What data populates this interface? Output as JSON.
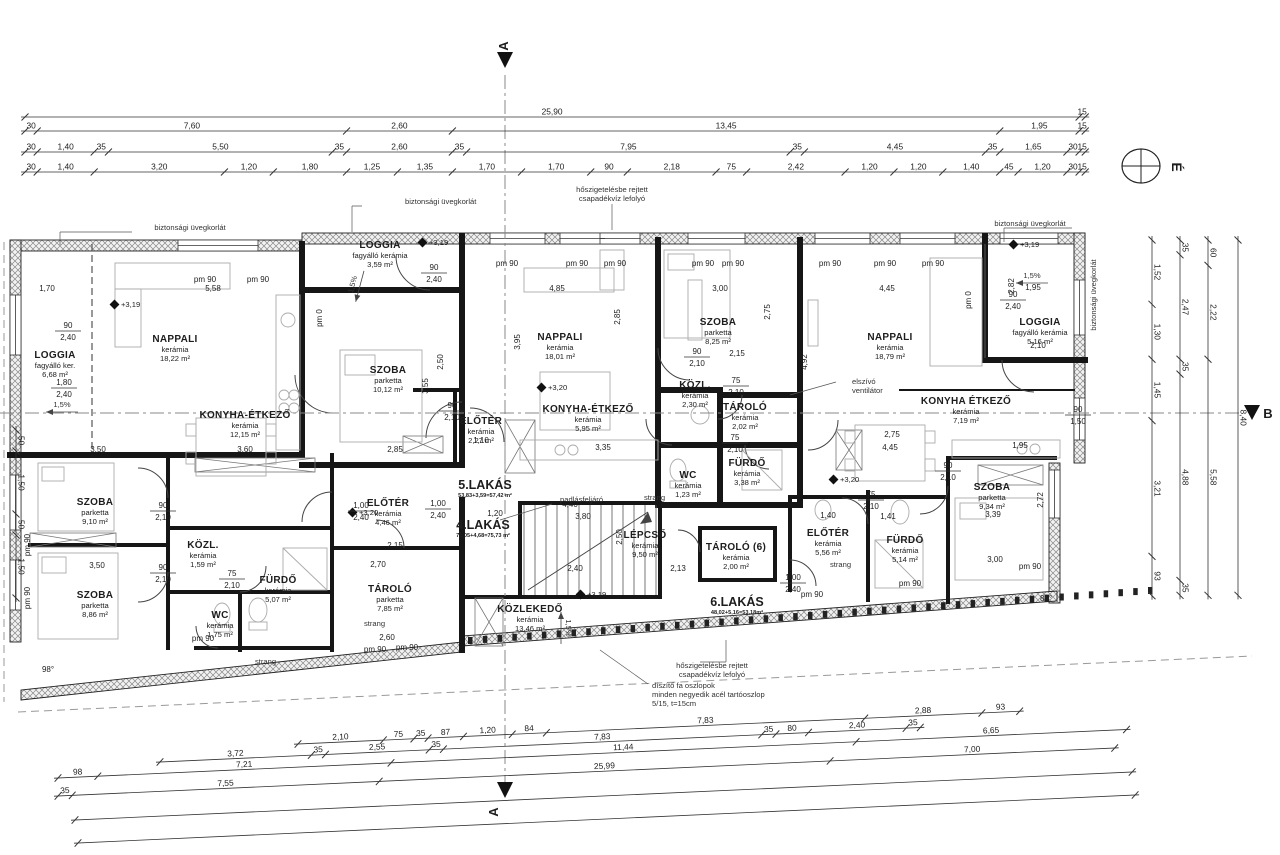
{
  "drawing": {
    "north_label": "É",
    "section_top": "A",
    "section_bottom": "A",
    "section_right": "B",
    "section_right_dim": "8,40",
    "window_sill_label": "pm 90",
    "window_zero_label": "pm 0"
  },
  "rooms": [
    {
      "id": "loggia1",
      "name": "LOGGIA",
      "material": "fagyálló ker.",
      "area": "6,68 m²"
    },
    {
      "id": "nappali1",
      "name": "NAPPALI",
      "material": "kerámia",
      "area": "18,22 m²"
    },
    {
      "id": "konyha1",
      "name": "KONYHA-ÉTKEZŐ",
      "material": "kerámia",
      "area": "12,15 m²"
    },
    {
      "id": "loggia2",
      "name": "LOGGIA",
      "material": "fagyálló kerámia",
      "area": "3,59 m²"
    },
    {
      "id": "szoba1",
      "name": "SZOBA",
      "material": "parketta",
      "area": "10,12 m²"
    },
    {
      "id": "eloter3",
      "name": "ELŐTÉR",
      "material": "kerámia",
      "area": "2,27 m²"
    },
    {
      "id": "nappali2",
      "name": "NAPPALI",
      "material": "kerámia",
      "area": "18,01 m²"
    },
    {
      "id": "konyha2",
      "name": "KONYHA-ÉTKEZŐ",
      "material": "kerámia",
      "area": "5,95 m²"
    },
    {
      "id": "szoba4",
      "name": "SZOBA",
      "material": "parketta",
      "area": "8,25 m²"
    },
    {
      "id": "kozl2",
      "name": "KÖZL.",
      "material": "kerámia",
      "area": "2,30 m²"
    },
    {
      "id": "tarolo2",
      "name": "TÁROLÓ",
      "material": "kerámia",
      "area": "2,02 m²"
    },
    {
      "id": "furdo2",
      "name": "FÜRDŐ",
      "material": "kerámia",
      "area": "3,38 m²"
    },
    {
      "id": "wc2",
      "name": "WC",
      "material": "kerámia",
      "area": "1,23 m²"
    },
    {
      "id": "nappali3",
      "name": "NAPPALI",
      "material": "kerámia",
      "area": "18,79 m²"
    },
    {
      "id": "konyha3",
      "name": "KONYHA ÉTKEZŐ",
      "material": "kerámia",
      "area": "7,19 m²"
    },
    {
      "id": "loggia3",
      "name": "LOGGIA",
      "material": "fagyálló kerámia",
      "area": "5,16 m²"
    },
    {
      "id": "szoba2",
      "name": "SZOBA",
      "material": "parketta",
      "area": "9,10 m²"
    },
    {
      "id": "szoba3",
      "name": "SZOBA",
      "material": "parketta",
      "area": "8,86 m²"
    },
    {
      "id": "kozl1",
      "name": "KÖZL.",
      "material": "kerámia",
      "area": "1,59 m²"
    },
    {
      "id": "furdo1",
      "name": "FÜRDŐ",
      "material": "kerámia",
      "area": "5,07 m²"
    },
    {
      "id": "wc1",
      "name": "WC",
      "material": "kerámia",
      "area": "1,75 m²"
    },
    {
      "id": "eloter1",
      "name": "ELŐTÉR",
      "material": "kerámia",
      "area": "4,46 m²"
    },
    {
      "id": "tarolo1",
      "name": "TÁROLÓ",
      "material": "parketta",
      "area": "7,85 m²"
    },
    {
      "id": "lepcso",
      "name": "LÉPCSŐ",
      "material": "kerámia",
      "area": "9,50 m²"
    },
    {
      "id": "kozlekedo",
      "name": "KÖZLEKEDŐ",
      "material": "kerámia",
      "area": "13,46 m²"
    },
    {
      "id": "tarolo6",
      "name": "TÁROLÓ (6)",
      "material": "kerámia",
      "area": "2,00 m²"
    },
    {
      "id": "eloter6",
      "name": "ELŐTÉR",
      "material": "kerámia",
      "area": "5,56 m²"
    },
    {
      "id": "furdo6",
      "name": "FÜRDŐ",
      "material": "kerámia",
      "area": "5,14 m²"
    },
    {
      "id": "szoba6",
      "name": "SZOBA",
      "material": "parketta",
      "area": "9,34 m²"
    }
  ],
  "apartments": [
    {
      "id": "a5",
      "name": "5.LAKÁS",
      "calc": "53,83+3,59=57,42 m²"
    },
    {
      "id": "a4",
      "name": "4.LAKÁS",
      "calc": "71,05+4,68=75,73 m²"
    },
    {
      "id": "a6",
      "name": "6.LAKÁS",
      "calc": "48,02+5,16=53,18m²"
    }
  ],
  "annotations": {
    "uvegkorlat": "biztonsági üvegkorlát",
    "csapadek1": "hőszigetelésbe rejtett",
    "csapadek2": "csapadékvíz lefolyó",
    "elszivo1": "elszívó",
    "elszivo2": "ventilátor",
    "padlas": "padlásfeljáró",
    "strang": "strang",
    "oszlop1": "díszítő fa oszlopok",
    "oszlop2": "minden negyedik acél tartóoszlop",
    "oszlop3": "5/15, t=15cm"
  },
  "levels": {
    "l319": "+3,19",
    "l320": "+3,20"
  },
  "slope": "1,5%",
  "angles": {
    "a98": "98°",
    "a82": "82°"
  },
  "door_labels": [
    {
      "id": "dl1",
      "top": "90",
      "bottom": "2,40"
    },
    {
      "id": "dl2",
      "top": "1,80",
      "bottom": "2,40"
    },
    {
      "id": "dl3",
      "top": "90",
      "bottom": "2,10"
    },
    {
      "id": "dl4",
      "top": "75",
      "bottom": "2,10"
    },
    {
      "id": "dl5",
      "top": "90",
      "bottom": "2,10"
    },
    {
      "id": "dl6",
      "top": "1,00",
      "bottom": "2,40"
    },
    {
      "id": "dl7",
      "top": "1,00",
      "bottom": "2,40"
    },
    {
      "id": "dl8",
      "top": "90",
      "bottom": "2,10"
    },
    {
      "id": "dl9",
      "top": "90",
      "bottom": "2,40"
    },
    {
      "id": "dl10",
      "top": "90",
      "bottom": "2,10"
    },
    {
      "id": "dl11",
      "top": "75",
      "bottom": "2,10"
    },
    {
      "id": "dl12",
      "top": "75",
      "bottom": "2,10"
    },
    {
      "id": "dl14",
      "top": "75",
      "bottom": "2,10"
    },
    {
      "id": "dl15",
      "top": "90",
      "bottom": "2,10"
    },
    {
      "id": "dl16",
      "top": "90",
      "bottom": "1,50"
    },
    {
      "id": "dl17",
      "top": "1,00",
      "bottom": "2,40"
    },
    {
      "id": "dl19",
      "top": "90",
      "bottom": "2,40"
    }
  ],
  "dims": [
    {
      "id": "d170",
      "text": "1,70"
    },
    {
      "id": "d558",
      "text": "5,58"
    },
    {
      "id": "d350a",
      "text": "3,50"
    },
    {
      "id": "d360",
      "text": "3,60"
    },
    {
      "id": "d285a",
      "text": "2,85"
    },
    {
      "id": "d485",
      "text": "4,85"
    },
    {
      "id": "d300a",
      "text": "3,00"
    },
    {
      "id": "d445a",
      "text": "4,45"
    },
    {
      "id": "d215a",
      "text": "2,15"
    },
    {
      "id": "d275a",
      "text": "2,75"
    },
    {
      "id": "d445b",
      "text": "4,45"
    },
    {
      "id": "d195a",
      "text": "1,95"
    },
    {
      "id": "d335",
      "text": "3,35"
    },
    {
      "id": "d195b",
      "text": "1,95"
    },
    {
      "id": "d282",
      "text": "2,82"
    },
    {
      "id": "d350b",
      "text": "3,50"
    },
    {
      "id": "d215b",
      "text": "2,15"
    },
    {
      "id": "d270",
      "text": "2,70"
    },
    {
      "id": "d260",
      "text": "2,60"
    },
    {
      "id": "d141",
      "text": "1,41"
    },
    {
      "id": "d339",
      "text": "3,39"
    },
    {
      "id": "d300b",
      "text": "3,00"
    },
    {
      "id": "d440",
      "text": "4,40"
    },
    {
      "id": "d380",
      "text": "3,80"
    },
    {
      "id": "d240s",
      "text": "2,40"
    },
    {
      "id": "d213",
      "text": "2,13"
    },
    {
      "id": "d140",
      "text": "1,40"
    },
    {
      "id": "d120",
      "text": "1,20"
    },
    {
      "id": "d395r",
      "text": "3,95"
    },
    {
      "id": "d285r",
      "text": "2,85"
    },
    {
      "id": "d250r",
      "text": "2,50"
    },
    {
      "id": "d355r",
      "text": "3,55"
    },
    {
      "id": "d275r",
      "text": "2,75"
    },
    {
      "id": "d492r",
      "text": "4,92"
    },
    {
      "id": "d250s",
      "text": "2,50"
    },
    {
      "id": "d272r",
      "text": "2,72"
    },
    {
      "id": "d110",
      "text": "1,10"
    },
    {
      "id": "d210r",
      "text": "2,10"
    }
  ],
  "dim_chains": {
    "top": [
      {
        "id": "t1",
        "segments": [
          {
            "v": 25.9,
            "label": "25,90"
          },
          {
            "v": 0.15,
            "label": "15"
          }
        ]
      },
      {
        "id": "t2",
        "segments": [
          {
            "v": 0.3,
            "label": "30"
          },
          {
            "v": 7.6,
            "label": "7,60"
          },
          {
            "v": 2.6,
            "label": "2,60"
          },
          {
            "v": 13.45,
            "label": "13,45"
          },
          {
            "v": 1.95,
            "label": "1,95"
          },
          {
            "v": 0.15,
            "label": "15"
          }
        ]
      },
      {
        "id": "t3",
        "segments": [
          {
            "v": 0.3,
            "label": "30"
          },
          {
            "v": 1.4,
            "label": "1,40"
          },
          {
            "v": 0.35,
            "label": "35"
          },
          {
            "v": 5.5,
            "label": "5,50"
          },
          {
            "v": 0.35,
            "label": "35"
          },
          {
            "v": 2.6,
            "label": "2,60"
          },
          {
            "v": 0.35,
            "label": "35"
          },
          {
            "v": 7.95,
            "label": "7,95"
          },
          {
            "v": 0.35,
            "label": "35"
          },
          {
            "v": 4.45,
            "label": "4,45"
          },
          {
            "v": 0.35,
            "label": "35"
          },
          {
            "v": 1.65,
            "label": "1,65"
          },
          {
            "v": 0.3,
            "label": "30"
          },
          {
            "v": 0.15,
            "label": "15"
          }
        ]
      },
      {
        "id": "t4",
        "segments": [
          {
            "v": 0.3,
            "label": "30"
          },
          {
            "v": 1.4,
            "label": "1,40"
          },
          {
            "v": 3.2,
            "label": "3,20"
          },
          {
            "v": 1.2,
            "label": "1,20"
          },
          {
            "v": 1.8,
            "label": "1,80"
          },
          {
            "v": 1.25,
            "label": "1,25"
          },
          {
            "v": 1.35,
            "label": "1,35"
          },
          {
            "v": 1.7,
            "label": "1,70"
          },
          {
            "v": 1.7,
            "label": "1,70"
          },
          {
            "v": 0.9,
            "label": "90"
          },
          {
            "v": 2.18,
            "label": "2,18"
          },
          {
            "v": 0.75,
            "label": "75"
          },
          {
            "v": 2.42,
            "label": "2,42"
          },
          {
            "v": 1.2,
            "label": "1,20"
          },
          {
            "v": 1.2,
            "label": "1,20"
          },
          {
            "v": 1.4,
            "label": "1,40"
          },
          {
            "v": 0.45,
            "label": "45"
          },
          {
            "v": 1.2,
            "label": "1,20"
          },
          {
            "v": 0.3,
            "label": "30"
          },
          {
            "v": 0.15,
            "label": "15"
          }
        ]
      }
    ],
    "bottom": [
      {
        "id": "b1",
        "segments": [
          {
            "v": 2.1,
            "label": "2,10"
          },
          {
            "v": 0.75,
            "label": "75"
          },
          {
            "v": 0.35,
            "label": "35"
          },
          {
            "v": 0.87,
            "label": "87"
          },
          {
            "v": 1.2,
            "label": "1,20"
          },
          {
            "v": 0.84,
            "label": "84"
          },
          {
            "v": 7.83,
            "label": "7,83"
          },
          {
            "v": 2.88,
            "label": "2,88"
          },
          {
            "v": 0.93,
            "label": "93"
          }
        ]
      },
      {
        "id": "b2",
        "segments": [
          {
            "v": 3.72,
            "label": "3,72"
          },
          {
            "v": 0.35,
            "label": "35"
          },
          {
            "v": 2.55,
            "label": "2,55"
          },
          {
            "v": 0.35,
            "label": "35"
          },
          {
            "v": 7.83,
            "label": "7,83"
          },
          {
            "v": 0.35,
            "label": "35"
          },
          {
            "v": 0.8,
            "label": "80"
          },
          {
            "v": 2.4,
            "label": "2,40"
          },
          {
            "v": 0.35,
            "label": "35"
          }
        ]
      },
      {
        "id": "b3",
        "segments": [
          {
            "v": 0.98,
            "label": "98"
          },
          {
            "v": 7.21,
            "label": "7,21"
          },
          {
            "v": 11.44,
            "label": "11,44"
          },
          {
            "v": 6.65,
            "label": "6,65"
          }
        ]
      },
      {
        "id": "b4",
        "segments": [
          {
            "v": 0.35,
            "label": "35"
          },
          {
            "v": 7.55,
            "label": "7,55"
          },
          {
            "v": 11.09,
            "label": "25,99"
          },
          {
            "v": 7.0,
            "label": "7,00"
          }
        ]
      },
      {
        "id": "b5",
        "segments": [
          {
            "v": 26.0,
            "label": ""
          }
        ]
      },
      {
        "id": "b6",
        "segments": [
          {
            "v": 26.0,
            "label": ""
          }
        ]
      }
    ],
    "right": [
      {
        "id": "r1",
        "segments": [
          {
            "v": 1.52,
            "label": "1,52"
          },
          {
            "v": 1.3,
            "label": "1,30"
          },
          {
            "v": 1.45,
            "label": "1,45"
          },
          {
            "v": 3.21,
            "label": "3,21"
          },
          {
            "v": 0.93,
            "label": "93"
          }
        ]
      },
      {
        "id": "r2",
        "segments": [
          {
            "v": 0.35,
            "label": "35"
          },
          {
            "v": 2.47,
            "label": "2,47"
          },
          {
            "v": 0.35,
            "label": "35"
          },
          {
            "v": 4.88,
            "label": "4,88"
          },
          {
            "v": 0.35,
            "label": "35"
          }
        ]
      },
      {
        "id": "r3",
        "segments": [
          {
            "v": 0.6,
            "label": "60"
          },
          {
            "v": 2.22,
            "label": "2,22"
          },
          {
            "v": 5.58,
            "label": "5,58"
          }
        ]
      },
      {
        "id": "r4",
        "segments": [
          {
            "v": 8.4,
            "label": "8,40"
          }
        ]
      }
    ],
    "left": [
      {
        "id": "l1",
        "segments": [
          {
            "v": 0.5,
            "label": "50"
          },
          {
            "v": 1.5,
            "label": "1,50"
          },
          {
            "v": 0.5,
            "label": "50"
          },
          {
            "v": 1.5,
            "label": "1,50"
          }
        ]
      }
    ]
  }
}
